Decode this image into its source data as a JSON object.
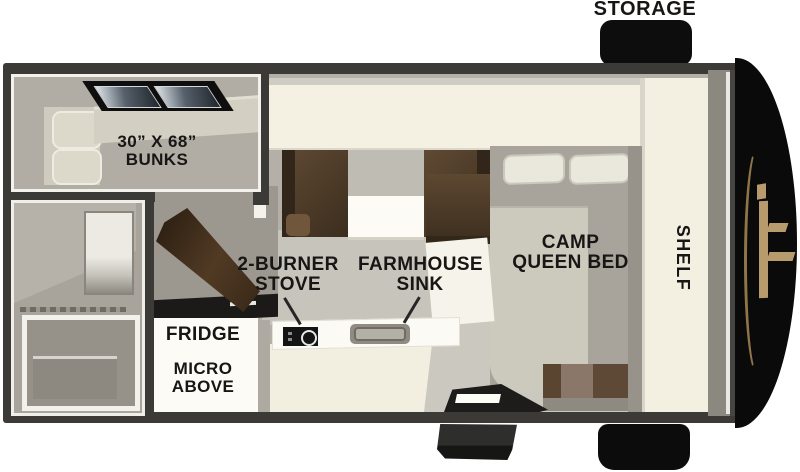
{
  "floorplan": {
    "type": "truck-camper-floor-plan",
    "labels": {
      "storage": "STORAGE",
      "bunks1": "30” X 68”",
      "bunks2": "BUNKS",
      "stove1": "2-BURNER",
      "stove2": "STOVE",
      "sink1": "FARMHOUSE",
      "sink2": "SINK",
      "fridge": "FRIDGE",
      "micro1": "MICRO",
      "micro2": "ABOVE",
      "bed1": "CAMP",
      "bed2": "QUEEN BED",
      "shelf": "SHELF"
    },
    "colors": {
      "wall": "#3b3a37",
      "cabinet_cream": "#f3f0e1",
      "floor": "#b4b0a8",
      "seat_brown": "#56422e",
      "door_brown": "#4e3827",
      "exterior_black": "#0d0d0d",
      "logo_tan": "#b89b6d",
      "label_text": "#171614"
    }
  }
}
